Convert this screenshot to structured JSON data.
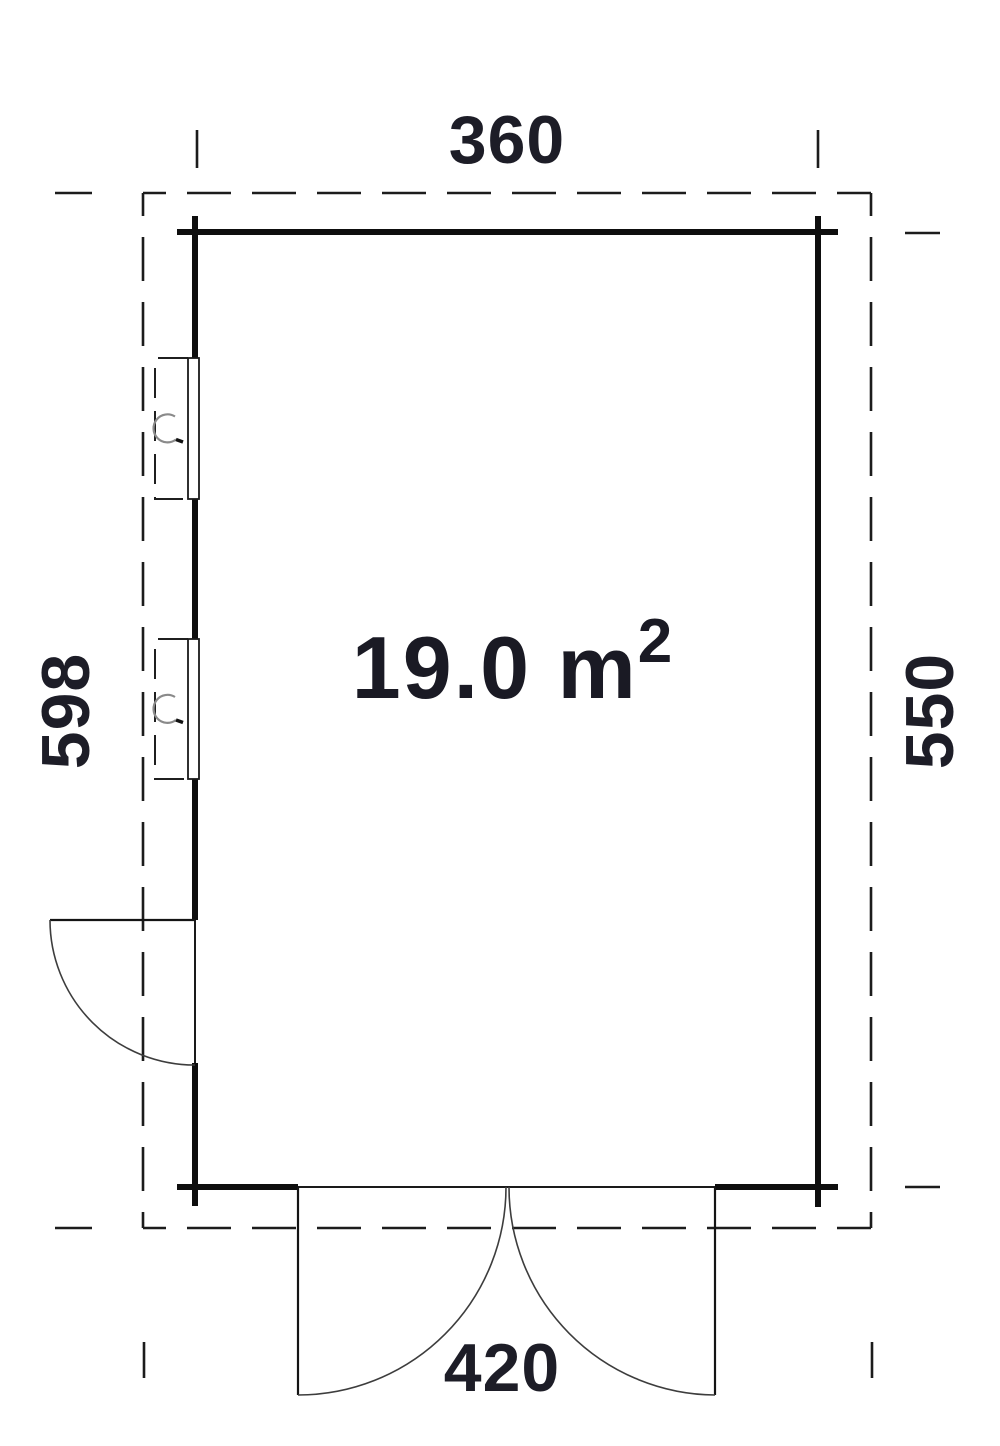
{
  "plan": {
    "title": "floor plan",
    "area_text": "19.0 m",
    "area_exponent": "2",
    "dim_top": "360",
    "dim_bottom": "420",
    "dim_left": "598",
    "dim_right": "550",
    "dimensions": {
      "wall_width_cm": 360,
      "wall_depth_cm": 550,
      "outline_width_cm": 420,
      "outline_depth_cm": 598,
      "area_m2": 19.0
    },
    "features": {
      "windows_left_wall": 2,
      "single_door_left_wall": 1,
      "double_door_bottom_wall": 1
    }
  },
  "colors": {
    "background": "#ffffff",
    "wall": "#0e0e0e",
    "dashed_outline": "#1c1c1c",
    "door_swing": "#3d3d3d",
    "window_handle": "#8a8a8a",
    "dimension_text": "#1d1d27",
    "area_text": "#1a1a24"
  }
}
